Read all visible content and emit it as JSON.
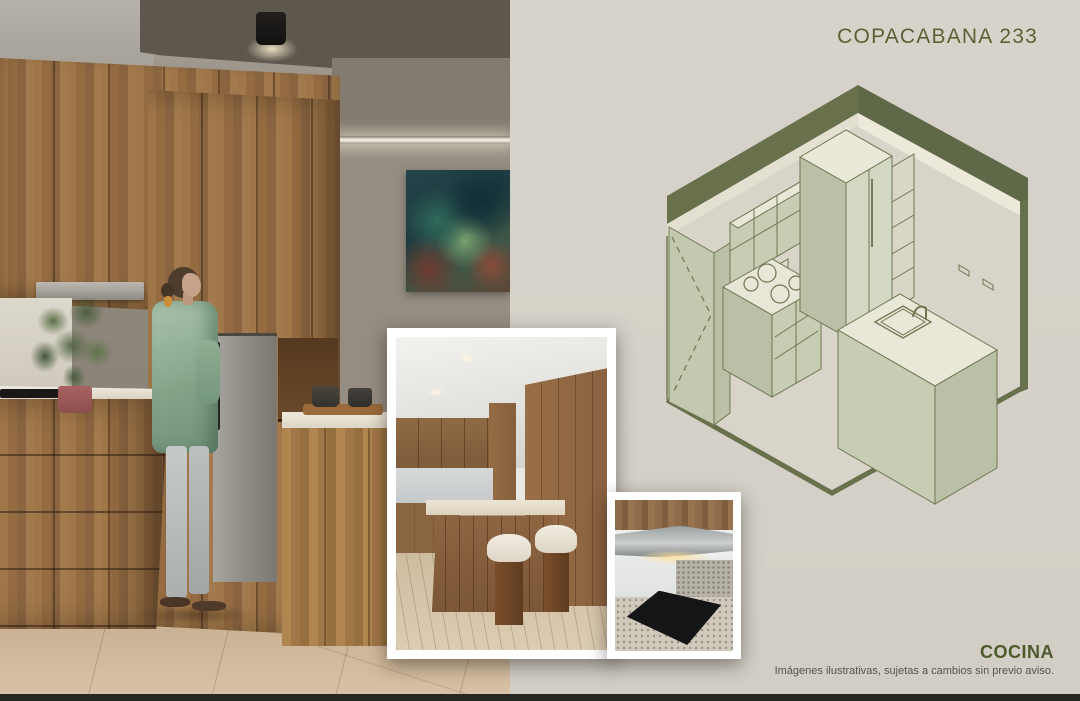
{
  "header": {
    "title": "COPACABANA 233"
  },
  "footer": {
    "section": "COCINA",
    "disclaimer": "Imágenes ilustrativas, sujetas a cambios sin previo aviso."
  },
  "colors": {
    "panel_bg": "#d5d1c8",
    "title_olive": "#5c6135",
    "caption_olive": "#4e5a2c",
    "disclaimer_gray": "#57524b",
    "drawing_band": "#68704c",
    "drawing_line": "#6f7651",
    "drawing_face": "#c7cdb3",
    "drawing_top": "#e9e7d8"
  }
}
